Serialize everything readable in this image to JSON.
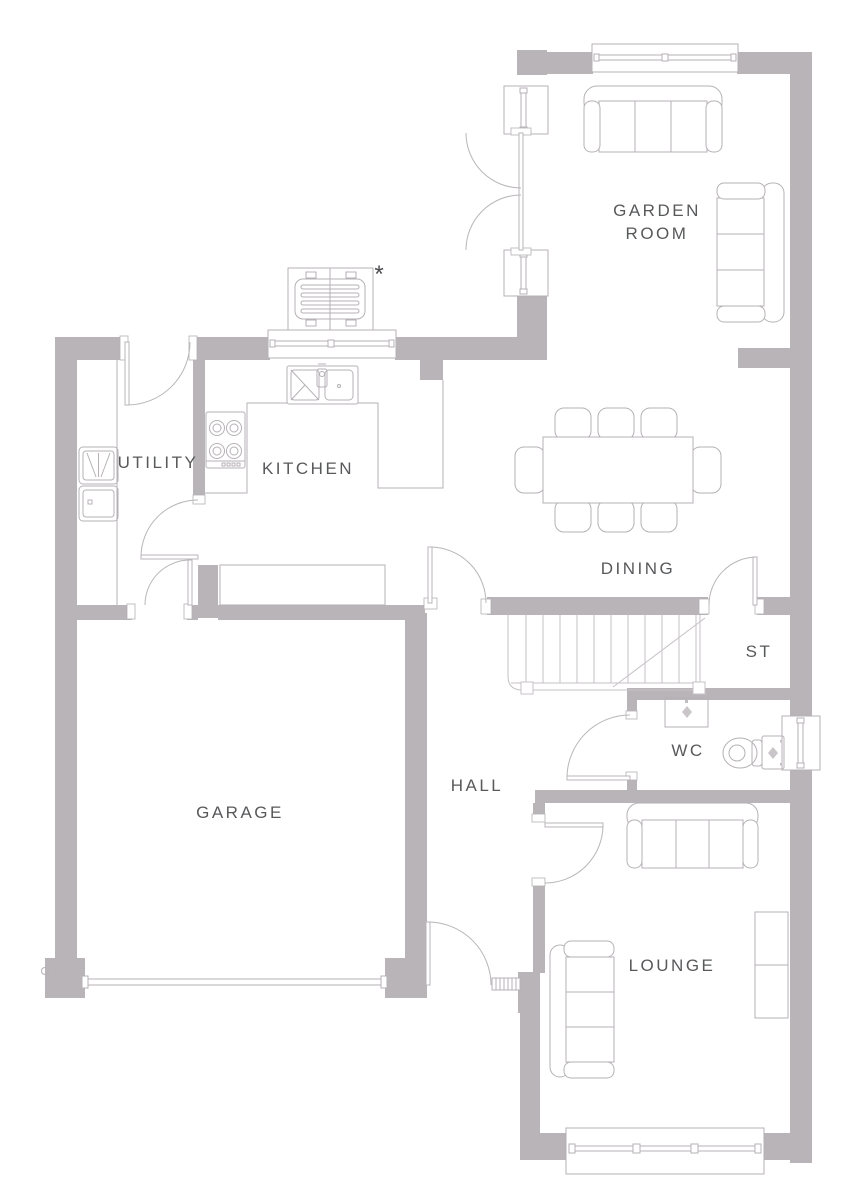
{
  "plan": {
    "type": "ground-floor plan",
    "rooms": {
      "garden_room": {
        "line1": "GARDEN",
        "line2": "ROOM"
      },
      "utility": {
        "label": "UTILITY"
      },
      "kitchen": {
        "label": "KITCHEN"
      },
      "dining": {
        "label": "DINING"
      },
      "storage": {
        "label": "ST"
      },
      "garage": {
        "label": "GARAGE"
      },
      "hall": {
        "label": "HALL"
      },
      "wc": {
        "label": "WC"
      },
      "lounge": {
        "label": "LOUNGE"
      }
    },
    "annotations": {
      "asterisk": "*"
    },
    "colors": {
      "wall": "#b8b4b8",
      "line": "#b5b1b5",
      "stairs_line": "#c6c2c6",
      "text": "#58595b",
      "background": "#ffffff"
    }
  }
}
